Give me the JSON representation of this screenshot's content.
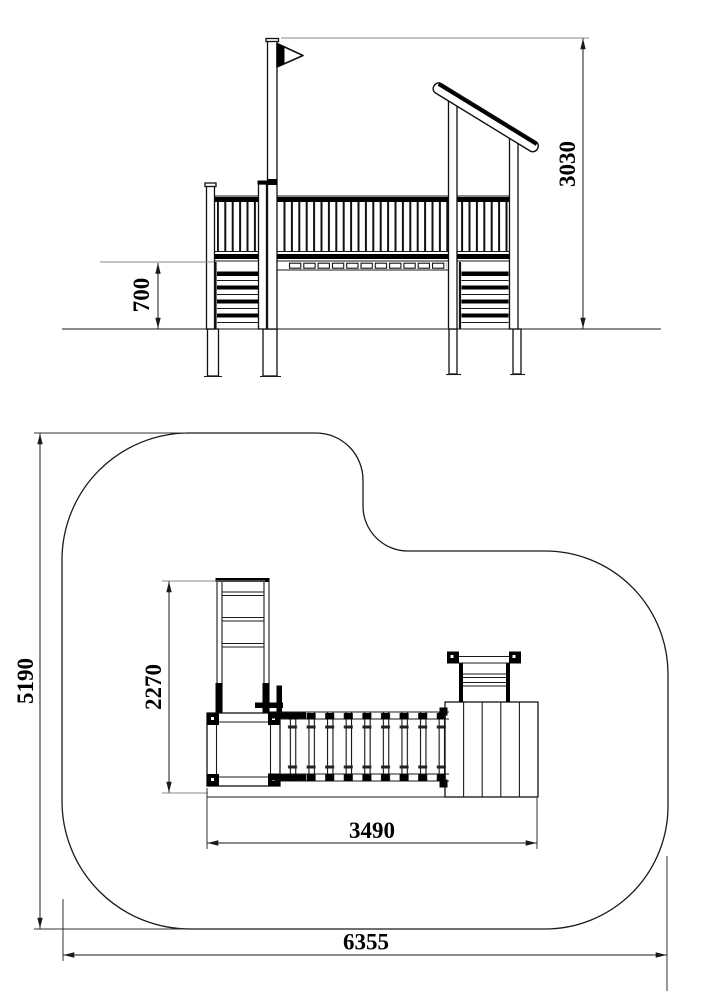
{
  "drawing": {
    "kind": "playground-equipment-technical-drawing",
    "line_color": "#1a1a1a",
    "extension_line_color": "#888888",
    "background_color": "#ffffff",
    "views": {
      "elevation": {
        "dims": {
          "platform_height": {
            "value": "700",
            "orientation": "vertical"
          },
          "total_height": {
            "value": "3030",
            "orientation": "vertical"
          }
        }
      },
      "plan": {
        "dims": {
          "structure_depth": {
            "value": "2270",
            "orientation": "vertical"
          },
          "structure_width": {
            "value": "3490",
            "orientation": "horizontal"
          },
          "safety_area_depth": {
            "value": "5190",
            "orientation": "vertical"
          },
          "safety_area_width": {
            "value": "6355",
            "orientation": "horizontal"
          }
        }
      }
    }
  }
}
